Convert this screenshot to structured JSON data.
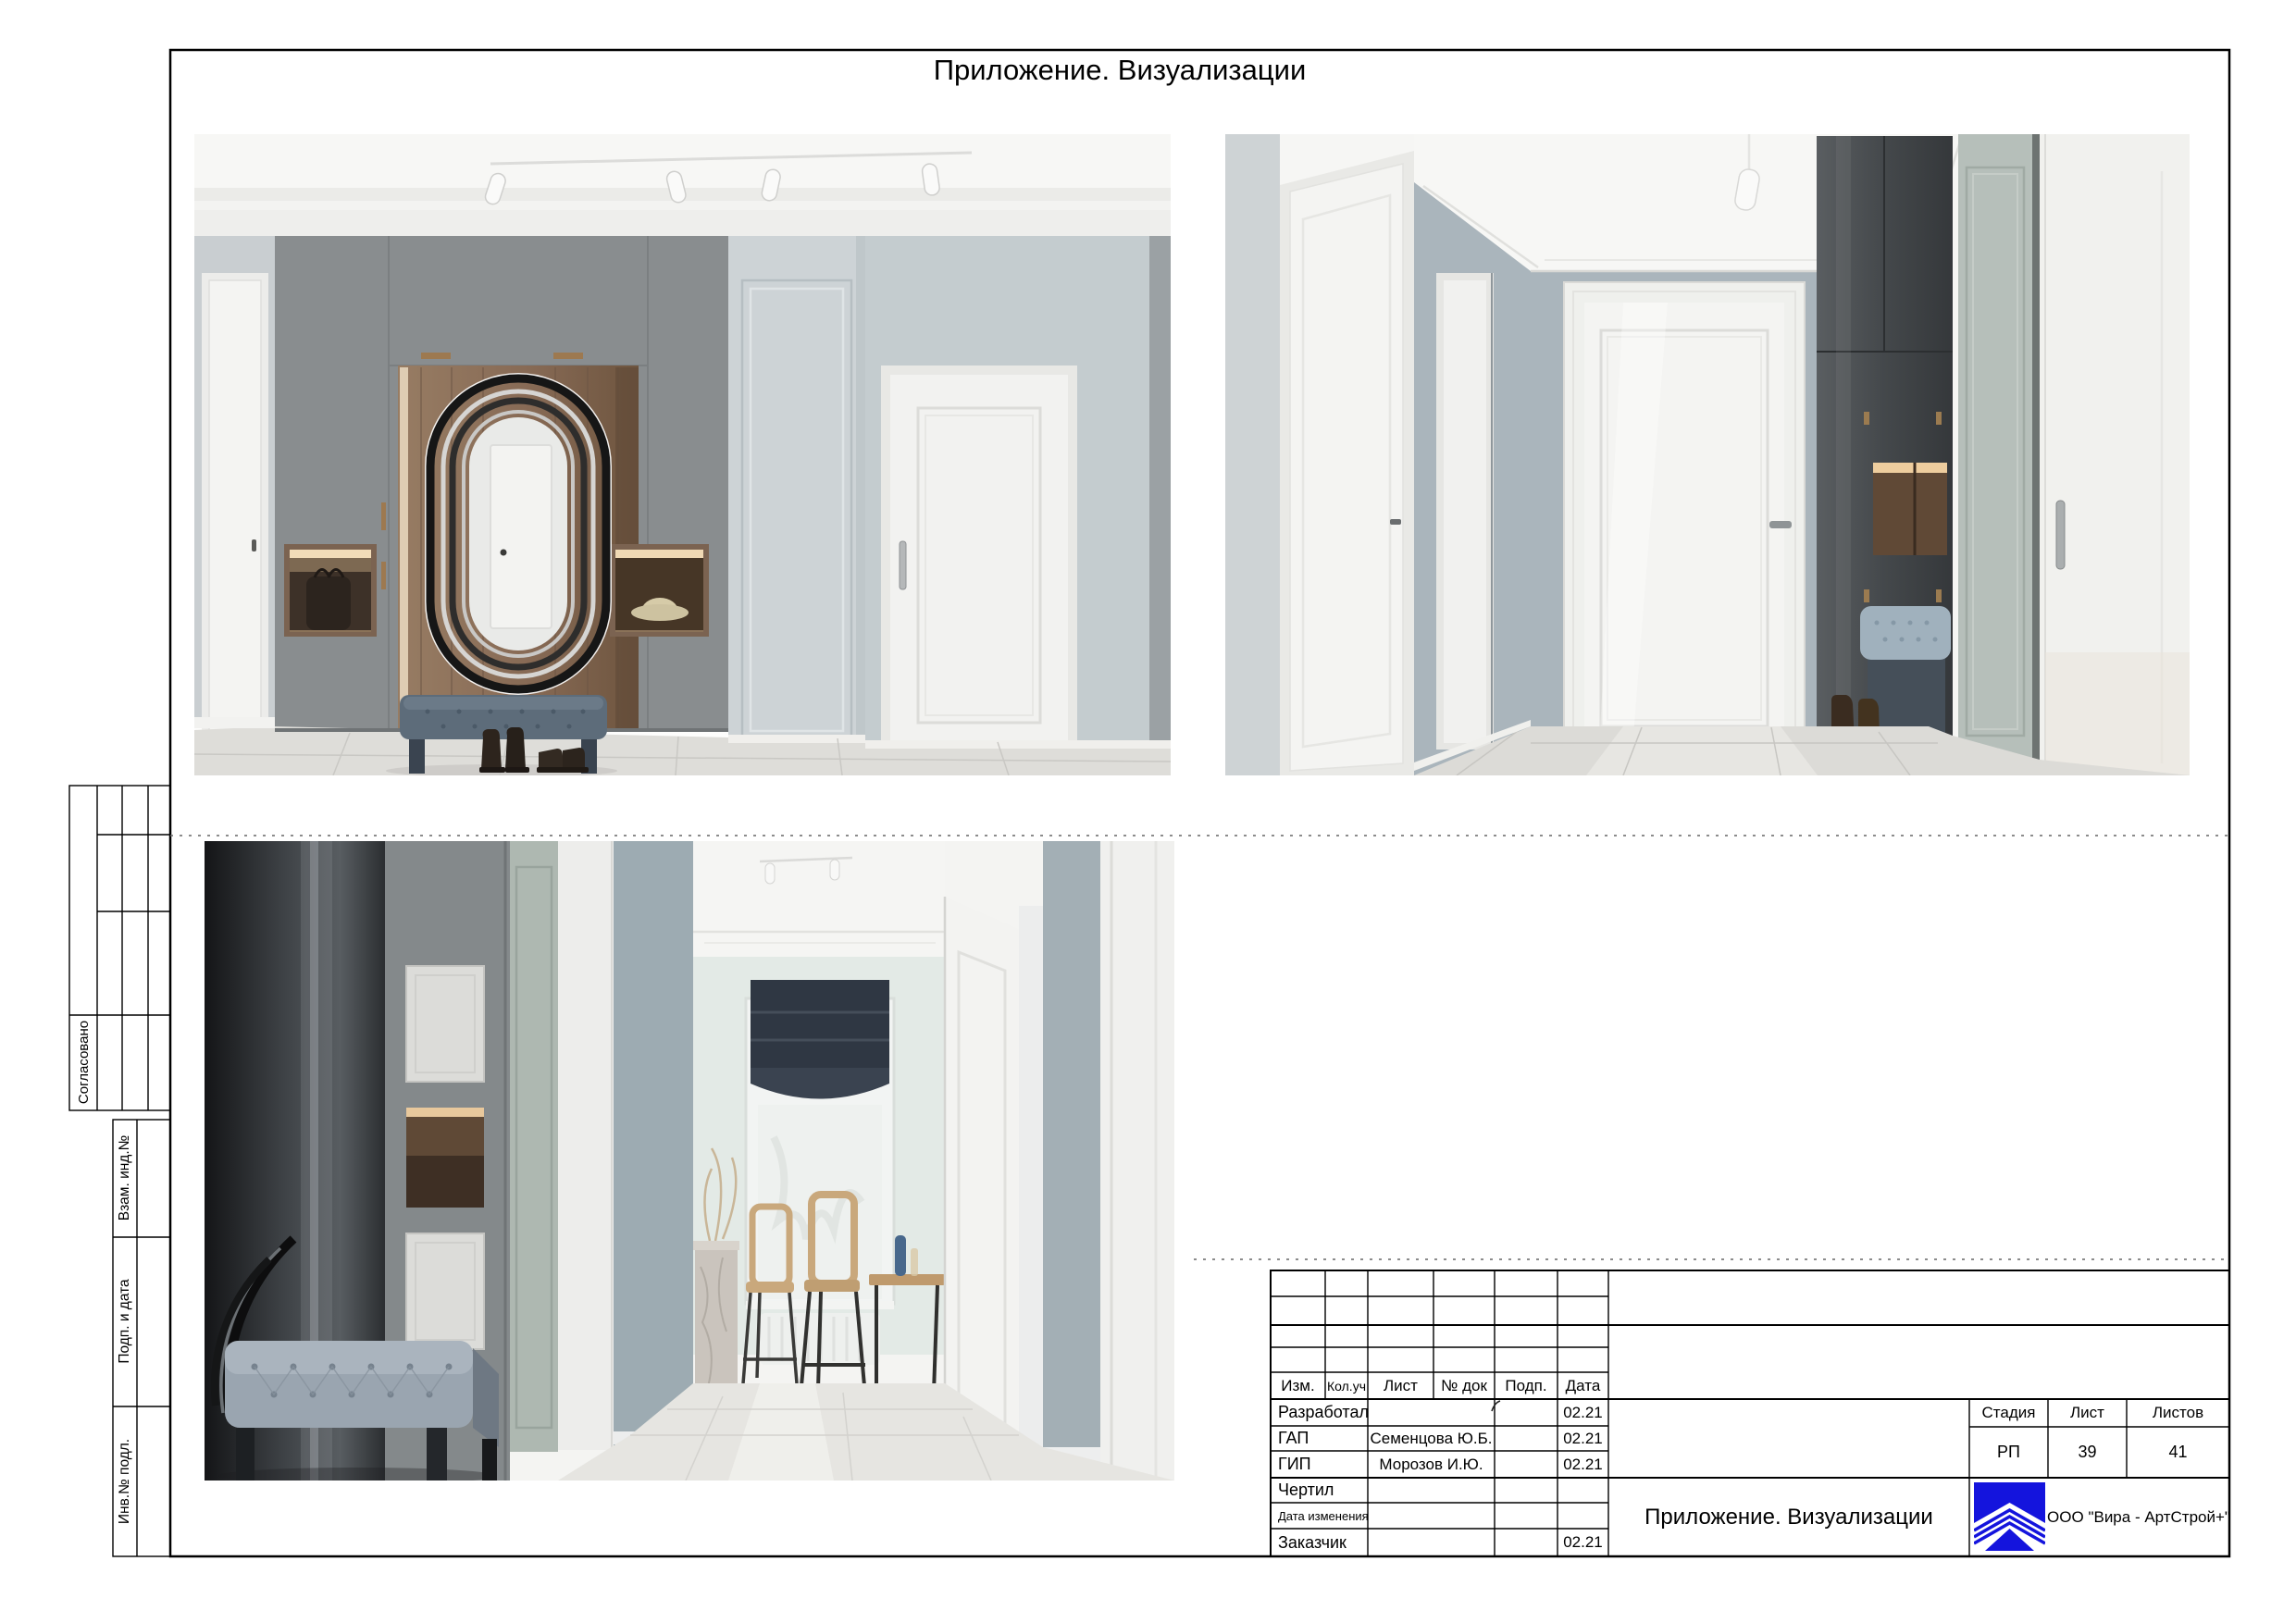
{
  "sheet": {
    "top_title": "Приложение. Визуализации",
    "colors": {
      "paper": "#ffffff",
      "line": "#000000",
      "logo_blue": "#1414dd"
    }
  },
  "side_panel": {
    "approved_label": "Согласовано",
    "cells": [
      {
        "label": "Взам. инд.№"
      },
      {
        "label": "Подп. и дата"
      },
      {
        "label": "Инв.№ подл."
      }
    ]
  },
  "title_block": {
    "header_columns": [
      "Изм.",
      "Кол.уч",
      "Лист",
      "№ док",
      "Подп.",
      "Дата"
    ],
    "rows": [
      {
        "role": "Разработал",
        "name": "",
        "date": "02.21"
      },
      {
        "role": "ГАП",
        "name": "Семенцова Ю.Б.",
        "date": "02.21"
      },
      {
        "role": "ГИП",
        "name": "Морозов И.Ю.",
        "date": "02.21"
      },
      {
        "role": "Чертил",
        "name": "",
        "date": ""
      },
      {
        "role": "Дата изменения",
        "name": "",
        "date": ""
      },
      {
        "role": "Заказчик",
        "name": "",
        "date": "02.21"
      }
    ],
    "doc_title": "Приложение. Визуализации",
    "stage_label": "Стадия",
    "stage_value": "РП",
    "sheet_label": "Лист",
    "sheet_value": "39",
    "sheets_label": "Листов",
    "sheets_value": "41",
    "company": "ООО \"Вира - АртСтрой+\""
  }
}
